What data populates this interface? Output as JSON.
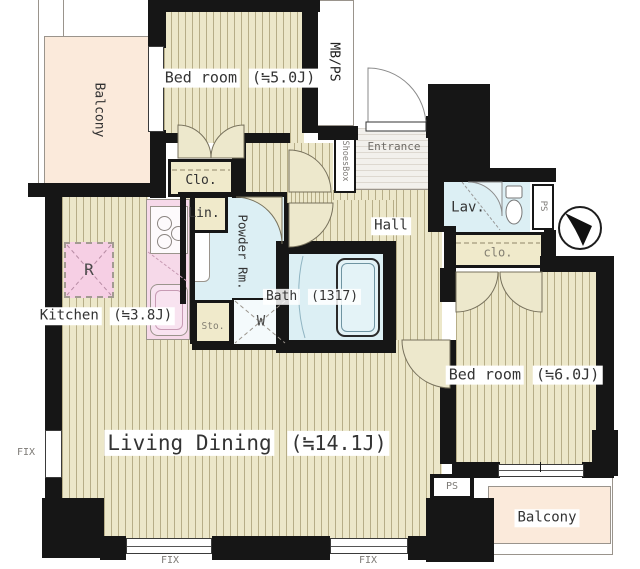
{
  "rooms": {
    "balcony_top": {
      "label": "Balcony"
    },
    "bedroom1": {
      "label": "Bed room",
      "size": "(≒5.0J)"
    },
    "mbps": {
      "label": "MB/PS"
    },
    "entrance": {
      "label": "Entrance"
    },
    "shoesbox": {
      "label": "ShoesBox"
    },
    "closet1": {
      "label": "Clo."
    },
    "linen": {
      "label": "Lin."
    },
    "powder": {
      "label": "Powder Rm."
    },
    "hall": {
      "label": "Hall"
    },
    "lavatory": {
      "label": "Lav."
    },
    "ps_upper": {
      "label": "PS"
    },
    "closet2": {
      "label": "clo."
    },
    "fridge": {
      "label": "R"
    },
    "kitchen": {
      "label": "Kitchen",
      "size": "(≒3.8J)"
    },
    "bath": {
      "label": "Bath",
      "size": "(1317)"
    },
    "storage": {
      "label": "Sto."
    },
    "washer": {
      "label": "W"
    },
    "bedroom2": {
      "label": "Bed room",
      "size": "(≒6.0J)"
    },
    "living_dining": {
      "label": "Living Dining",
      "size": "(≒14.1J)"
    },
    "ps_lower": {
      "label": "PS"
    },
    "balcony_bottom": {
      "label": "Balcony"
    }
  },
  "windows": {
    "fix_left": {
      "label": "FIX"
    },
    "fix_bottom_left": {
      "label": "FIX"
    },
    "fix_bottom_right": {
      "label": "FIX"
    }
  },
  "colors": {
    "wall": "#161616",
    "floor": "#ece7c9",
    "floor_stripe": "#b6ad87",
    "balcony": "#fbeadb",
    "wet_area": "#dceff4",
    "closet": "#f0eacb",
    "kitchen_counter": "#f6d9e9",
    "fridge_pink": "#f6cfe4"
  }
}
